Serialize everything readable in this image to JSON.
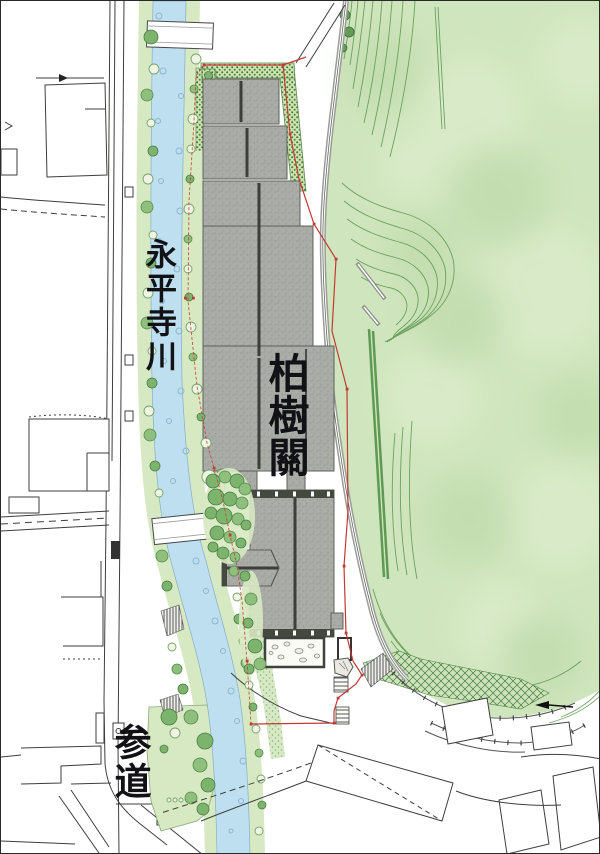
{
  "labels": {
    "river": "永平寺川",
    "main_building": "柏樹關",
    "approach": "参道"
  },
  "colors": {
    "paper": "#ffffff",
    "hill-green": "#cfe5bd",
    "contour-green": "#5b9551",
    "bank-green": "#d7e9c2",
    "tree-green": "#7cb36d",
    "river-blue": "#bedff0",
    "building-gray": "#a9aca6",
    "roof-ridge": "#3c3f3a",
    "boundary-red": "#c23a33",
    "ink": "#3e3e3c"
  }
}
